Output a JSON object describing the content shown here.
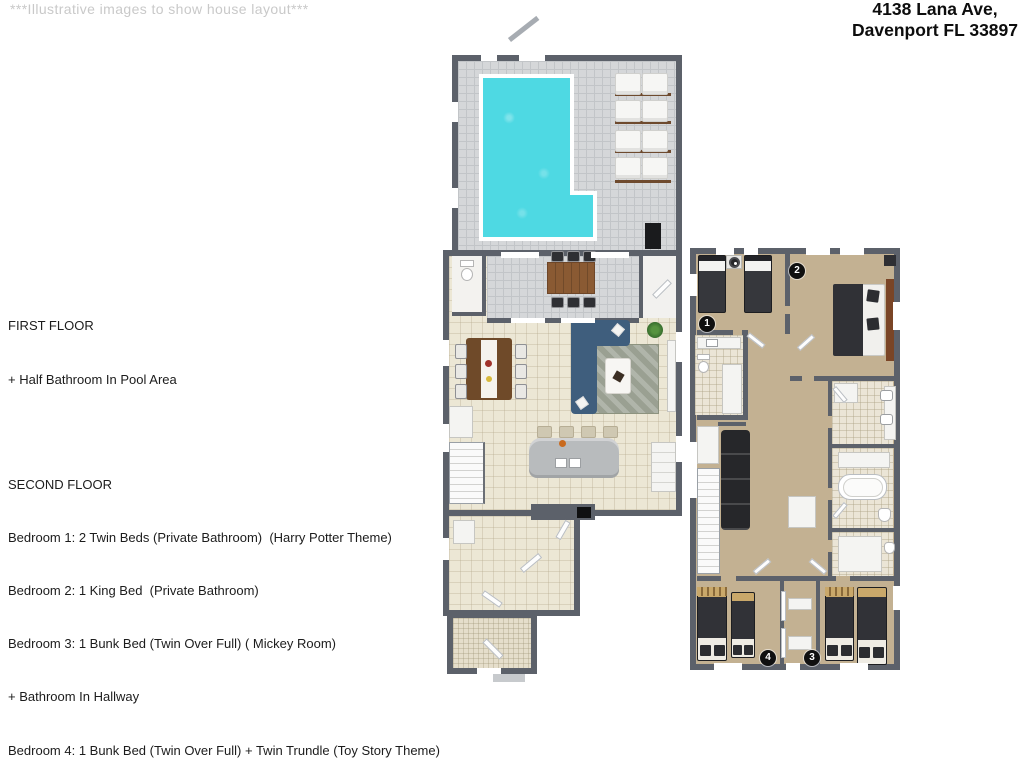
{
  "page": {
    "note": "***Illustrative images to show house layout***",
    "address": {
      "line1": "4138 Lana Ave,",
      "line2": "Davenport FL 33897"
    }
  },
  "description": {
    "first_floor": {
      "title": "FIRST FLOOR",
      "lines": [
        "+ Half Bathroom In Pool Area"
      ]
    },
    "second_floor": {
      "title": "SECOND FLOOR",
      "lines": [
        "Bedroom 1: 2 Twin Beds (Private Bathroom)  (Harry Potter Theme)",
        "Bedroom 2: 1 King Bed  (Private Bathroom)",
        "Bedroom 3: 1 Bunk Bed (Twin Over Full) ( Mickey Room)",
        "+ Bathroom In Hallway",
        "Bedroom 4: 1 Bunk Bed (Twin Over Full) + Twin Trundle (Toy Story Theme)"
      ]
    }
  },
  "floorplans": {
    "second": {
      "markers": {
        "bedroom1": "1",
        "bedroom2": "2",
        "bedroom3": "3",
        "bedroom4": "4"
      }
    }
  },
  "colors": {
    "wall": "#5c616a",
    "deck_tile": "#d5d7d9",
    "pool_water": "#4ed9e3",
    "floor_cream": "#ece7d5",
    "entry_tile": "#e5decb",
    "carpet": "#c3b192",
    "bath_tile": "#ebe5d6",
    "sofa_navy": "#3f5e7d",
    "wood": "#8a5a33",
    "dark_furniture": "#313237",
    "rug_green": "#9aa092",
    "island_gray": "#b8bbbd",
    "marker": "#101010"
  }
}
